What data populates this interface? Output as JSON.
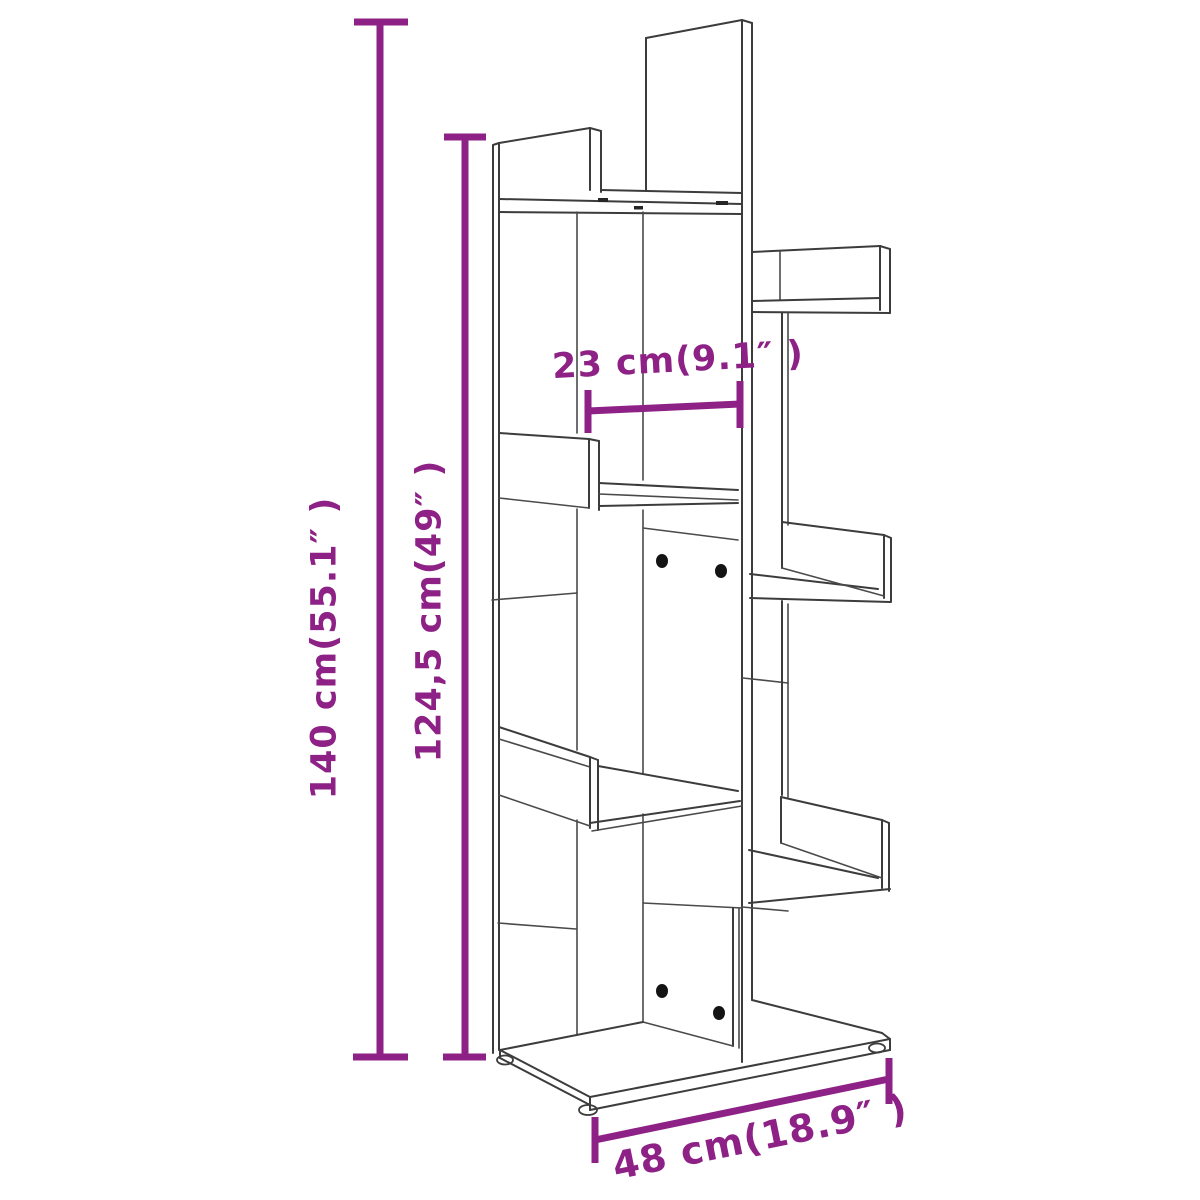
{
  "diagram": {
    "type": "furniture-dimension-drawing",
    "subject": "tree-style bookshelf line drawing",
    "colors": {
      "dimension_annotation": "#8d2186",
      "drawing_line": "#3c3c3c",
      "background": "#ffffff"
    },
    "dimensions": {
      "total_height": "140 cm(55.1″ )",
      "side_height": "124,5 cm(49″ )",
      "inner_width": "23 cm(9.1″ )",
      "total_width": "48 cm(18.9″ )"
    }
  }
}
